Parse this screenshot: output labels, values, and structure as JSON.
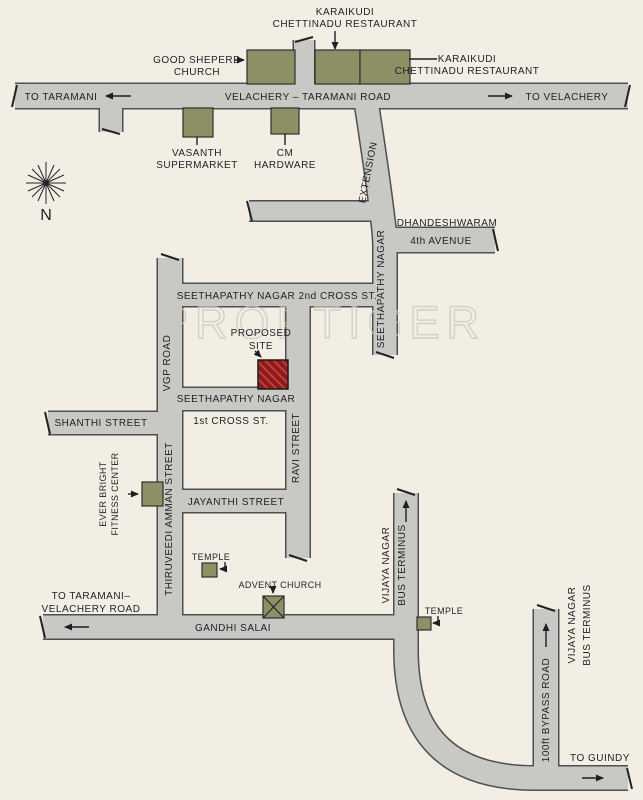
{
  "map": {
    "colors": {
      "background": "#f3eee3",
      "road_fill": "#c8c9c5",
      "road_casing": "#4e4f53",
      "building": "#8c9064",
      "building_border": "#2f2f30",
      "proposed_site_red": "#91191c",
      "proposed_site_hatch": "#bf4a41",
      "watermark_gray": "#c9c6bd"
    },
    "compass_label": "N",
    "watermark": "PROPTIGER",
    "roads": {
      "velachery_taramani": "VELACHERY – TARAMANI ROAD",
      "to_taramani": "TO TARAMANI",
      "to_velachery": "TO VELACHERY",
      "seethapathy_nagar_extension": [
        "SEETHAPATHY NAGAR",
        "EXTENSION"
      ],
      "dhandeshwaram_4th_avenue": [
        "DHANDESHWARAM",
        "4th AVENUE"
      ],
      "seethapathy_2nd_cross": "SEETHAPATHY NAGAR 2nd CROSS ST.",
      "vgp_road": "VGP ROAD",
      "seethapathy_1st_cross": [
        "SEETHAPATHY NAGAR",
        "1st CROSS ST."
      ],
      "shanthi_street": "SHANTHI STREET",
      "ravi_street": "RAVI STREET",
      "jayanthi_street": "JAYANTHI STREET",
      "thiruveedi_amman_street": "THIRUVEEDI AMMAN STREET",
      "gandhi_salai": "GANDHI SALAI",
      "to_taramani_velachery_road": [
        "TO TARAMANI–",
        "VELACHERY ROAD"
      ],
      "vijaya_nagar_mid": [
        "VIJAYA NAGAR",
        "BUS TERMINUS"
      ],
      "bypass_road": "100ft BYPASS ROAD",
      "vijaya_nagar_right": [
        "VIJAYA NAGAR",
        "BUS TERMINUS"
      ],
      "to_guindy": "TO GUINDY"
    },
    "places": {
      "karaikudi_restaurant_top": [
        "KARAIKUDI",
        "CHETTINADU RESTAURANT"
      ],
      "good_sheperd_church": [
        "GOOD SHEPERD",
        "CHURCH"
      ],
      "karaikudi_restaurant_right": [
        "KARAIKUDI",
        "CHETTINADU RESTAURANT"
      ],
      "vasanth_supermarket": [
        "VASANTH",
        "SUPERMARKET"
      ],
      "cm_hardware": [
        "CM",
        "HARDWARE"
      ],
      "proposed_site": [
        "PROPOSED",
        "SITE"
      ],
      "ever_bright_fitness_center": [
        "EVER BRIGHT",
        "FITNESS CENTER"
      ],
      "temple_1": "TEMPLE",
      "advent_church": "ADVENT CHURCH",
      "temple_2": "TEMPLE"
    }
  }
}
